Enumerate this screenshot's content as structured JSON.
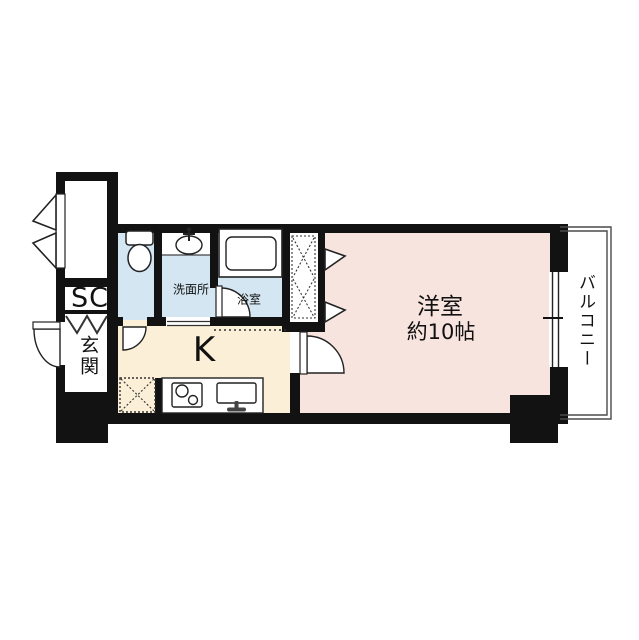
{
  "floorplan": {
    "western_room": {
      "label": "洋室",
      "size_label": "約10帖"
    },
    "kitchen": {
      "label": "K"
    },
    "balcony": {
      "label": "バルコニー"
    },
    "shoe_closet": {
      "label": "SC"
    },
    "entrance": {
      "label": "玄関"
    },
    "washroom": {
      "label": "洗面所"
    },
    "bathroom": {
      "label": "浴室"
    }
  },
  "colors": {
    "western_room": "#f8e4de",
    "kitchen": "#fbf0d7",
    "wet_area": "#d4e6f2",
    "wall": "#121212",
    "background": "#ffffff"
  }
}
